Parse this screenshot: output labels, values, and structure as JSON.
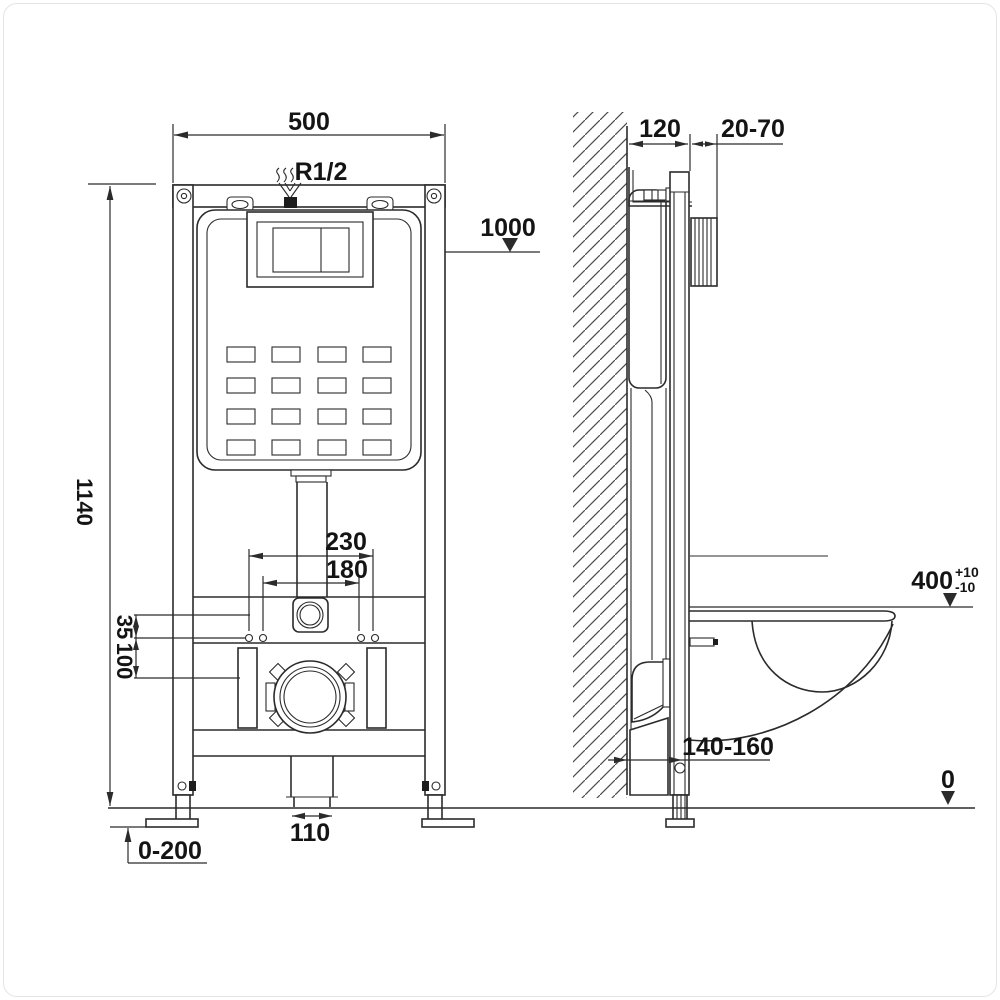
{
  "drawing": {
    "type": "technical-installation-diagram",
    "subject": "concealed cistern wall-hung WC mounting frame, front view and side section"
  },
  "dims": {
    "front_width": "500",
    "inlet_thread": "R1/2",
    "level_1000": "1000",
    "frame_height": "1140",
    "fixing_outer": "230",
    "fixing_inner": "180",
    "offset_small": "35",
    "offset_large": "100",
    "drain_width": "110",
    "foot_range": "0-200",
    "depth": "120",
    "plate_range": "20-70",
    "seat_height": "400",
    "seat_tol_plus": "+10",
    "seat_tol_minus": "-10",
    "wall_offset_range": "140-160",
    "floor_level": "0"
  },
  "colors": {
    "line": "#2b2b2b",
    "text": "#141414",
    "background": "#ffffff"
  }
}
